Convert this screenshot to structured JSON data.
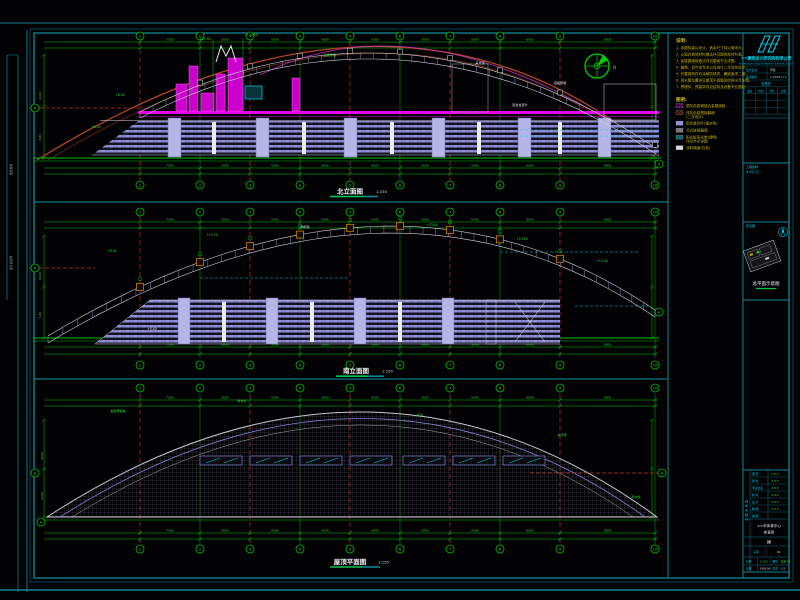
{
  "app": {
    "name": "CAD 立面图纸视图",
    "background": "#020205"
  },
  "colors": {
    "frame": "#0f8796",
    "frame_bright": "#1191a1",
    "cyan": "#00dcec",
    "green": "#00bf00",
    "green_bright": "#2ee02e",
    "red_grid": "#b43030",
    "arch_red": "#b4461e",
    "magenta": "#e800e8",
    "lavender": "#9191de",
    "white": "#e2e2ea",
    "yellow": "#c9b70f",
    "gray_hatch": "#565660",
    "orange": "#d08000"
  },
  "grid": {
    "column_labels": [
      "1",
      "2",
      "3",
      "4",
      "5",
      "6",
      "7",
      "8",
      "9",
      "10"
    ],
    "column_x": [
      140,
      200,
      250,
      300,
      350,
      400,
      450,
      500,
      560,
      655
    ],
    "red_columns": [
      0,
      2,
      4,
      6,
      8
    ],
    "row_labels": [
      "A",
      "B"
    ]
  },
  "compass": {
    "label": "N"
  },
  "left_edge": {
    "labels": [
      "图纸目录",
      "设计总说明"
    ]
  },
  "drawings": [
    {
      "name": "north-elevation",
      "title": "北立面图",
      "scale": "1:150",
      "top_dims": [
        "7500",
        "5000",
        "5000",
        "5000",
        "5000",
        "5000",
        "5000",
        "6000",
        "9500"
      ],
      "bottom_dims": [
        "7500",
        "5000",
        "5000",
        "5000",
        "5000",
        "5000",
        "5000",
        "6000",
        "9500"
      ],
      "left_dims": [
        {
          "x": 41,
          "y": 100,
          "t": "21.00"
        },
        {
          "x": 41,
          "y": 140,
          "t": "8.40"
        }
      ],
      "side_bubbles": [
        {
          "x": 35,
          "y": 108,
          "label": "B"
        },
        {
          "x": 659,
          "y": 164,
          "label": "A"
        }
      ],
      "annotations": [
        {
          "x": 205,
          "y": 40,
          "t": "+21.50",
          "c": "#2ee02e"
        },
        {
          "x": 252,
          "y": 36,
          "t": "+23.00",
          "c": "#2ee02e"
        },
        {
          "x": 120,
          "y": 96,
          "t": "+8.50",
          "c": "#2ee02e"
        },
        {
          "x": 330,
          "y": 56,
          "t": "金属屋面",
          "c": "#2ee02e"
        },
        {
          "x": 480,
          "y": 64,
          "t": "采光带",
          "c": "#e2e2ea"
        },
        {
          "x": 560,
          "y": 84,
          "t": "铝板幕墙",
          "c": "#e2e2ea"
        },
        {
          "x": 96,
          "y": 128,
          "t": "+6.00",
          "c": "#2ee02e"
        },
        {
          "x": 520,
          "y": 106,
          "t": "铝合金百叶",
          "c": "#e2e2ea"
        }
      ]
    },
    {
      "name": "south-elevation",
      "title": "南立面图",
      "scale": "1:150",
      "top_dims": [
        "7500",
        "5000",
        "5000",
        "5000",
        "5000",
        "5000",
        "5000",
        "6000",
        "9500"
      ],
      "bottom_dims": [
        "7500",
        "5000",
        "5000",
        "5000",
        "5000",
        "5000",
        "5000",
        "6000",
        "9500"
      ],
      "left_dims": [
        {
          "x": 41,
          "y": 280,
          "t": "15.00"
        },
        {
          "x": 41,
          "y": 318,
          "t": "5.40"
        }
      ],
      "side_bubbles": [
        {
          "x": 35,
          "y": 268,
          "label": "B"
        },
        {
          "x": 659,
          "y": 312,
          "label": "A"
        }
      ],
      "annotations": [
        {
          "x": 112,
          "y": 252,
          "t": "+9.00",
          "c": "#2ee02e"
        },
        {
          "x": 212,
          "y": 236,
          "t": "+15.20",
          "c": "#2ee02e"
        },
        {
          "x": 305,
          "y": 228,
          "t": "钢桁架",
          "c": "#e2e2ea"
        },
        {
          "x": 432,
          "y": 226,
          "t": "+23.00",
          "c": "#2ee02e"
        },
        {
          "x": 522,
          "y": 240,
          "t": "+19.80",
          "c": "#2ee02e"
        },
        {
          "x": 602,
          "y": 262,
          "t": "+12.00",
          "c": "#2ee02e"
        },
        {
          "x": 152,
          "y": 330,
          "t": "+5.40",
          "c": "#e2e2ea"
        }
      ]
    },
    {
      "name": "roof-plan",
      "title": "屋顶平面图",
      "scale": "1:150",
      "top_dims": [
        "7500",
        "5000",
        "5000",
        "5000",
        "5000",
        "5000",
        "5000",
        "6000",
        "9500"
      ],
      "bottom_dims": [
        "7500",
        "5000",
        "5000",
        "5000",
        "5000",
        "5000",
        "5000",
        "6000",
        "9500"
      ],
      "left_dims": [
        {
          "x": 43,
          "y": 460,
          "t": "33.00"
        },
        {
          "x": 43,
          "y": 500,
          "t": "12.00"
        }
      ],
      "side_bubbles": [
        {
          "x": 35,
          "y": 473,
          "label": "B"
        },
        {
          "x": 41,
          "y": 522,
          "label": "A"
        },
        {
          "x": 662,
          "y": 473,
          "label": "A"
        }
      ],
      "slot_x": [
        200,
        250,
        300,
        350,
        403,
        453,
        503
      ],
      "annotations": [
        {
          "x": 118,
          "y": 412,
          "t": "金属屋面板",
          "c": "#2ee02e"
        },
        {
          "x": 242,
          "y": 402,
          "t": "屋脊线",
          "c": "#2ee02e"
        },
        {
          "x": 420,
          "y": 416,
          "t": "天沟",
          "c": "#2ee02e"
        },
        {
          "x": 562,
          "y": 436,
          "t": "采光带",
          "c": "#2ee02e"
        },
        {
          "x": 636,
          "y": 498,
          "t": "雨水管",
          "c": "#2ee02e"
        }
      ]
    }
  ],
  "notes": {
    "title": "说明:",
    "items": [
      "1. 本图标高以米计，其余尺寸均以毫米计。",
      "2. 立面外装修材料做法详见图例及材料表。",
      "3. 金属屋面板做法详见屋面节点详图。",
      "4. 幕墙、百叶由专业公司进行二次深化设计。",
      "5. 外露钢构件均涂刷防锈漆、氟碳面漆二度。",
      "6. 雨水管位置详见屋顶平面图及给排水专业图。",
      "7. 预埋件、预留洞详见结构及设备专业图纸。"
    ]
  },
  "legend": {
    "title": "图例:",
    "items": [
      {
        "sw": "magenta",
        "label": "银灰色铝镁锰合金屋面板"
      },
      {
        "sw": "red",
        "label": "浅灰色铝塑板幕墙",
        "label2": "(二次设计)"
      },
      {
        "sw": "lavender",
        "label": "铝合金百叶(银灰色)"
      },
      {
        "sw": "gray",
        "label": "点式玻璃幕墙"
      },
      {
        "sw": "cyan",
        "label": "阳光板采光带(透明)",
        "label2": "详见节点详图"
      },
      {
        "sw": "white",
        "label": "涂料墙面(白色)"
      }
    ]
  },
  "title_block": {
    "company": "××建筑设计研究院有限公司",
    "company_en": "Architectural Design & Research Institute Co.,Ltd.",
    "cert_rows": [
      [
        "设计证书",
        "甲级"
      ],
      [
        "证书编号",
        "A-2008×××"
      ]
    ],
    "sign_grid": {
      "title": "会签栏",
      "columns": [
        "专业",
        "姓名",
        "签名",
        "日期"
      ]
    },
    "project_label": "工程名称",
    "project_sub": "体育场工程",
    "site_label": "区位图",
    "site_caption": "总平面示意图",
    "strip": "出图专用章",
    "sig_rows": [
      {
        "label": "审 定",
        "value": "×××"
      },
      {
        "label": "审 核",
        "value": "×××"
      },
      {
        "label": "专业负责",
        "value": "×××"
      },
      {
        "label": "校 对",
        "value": "×××"
      },
      {
        "label": "设 计",
        "value": "×××"
      },
      {
        "label": "制 图",
        "value": "×××"
      },
      {
        "label": "描 图",
        "value": ""
      }
    ],
    "project_name": [
      "××市体育中心",
      "体育场"
    ],
    "stage": "建",
    "sub_label": "子项",
    "sub_value": "01",
    "cells": {
      "scale_l": "比例",
      "scale_v": "1:150",
      "no_l": "图号",
      "no_v": "建施-03",
      "date_l": "日期",
      "date_v": "2008.06",
      "sheet_l": "张次",
      "sheet_v": "1/3"
    }
  }
}
